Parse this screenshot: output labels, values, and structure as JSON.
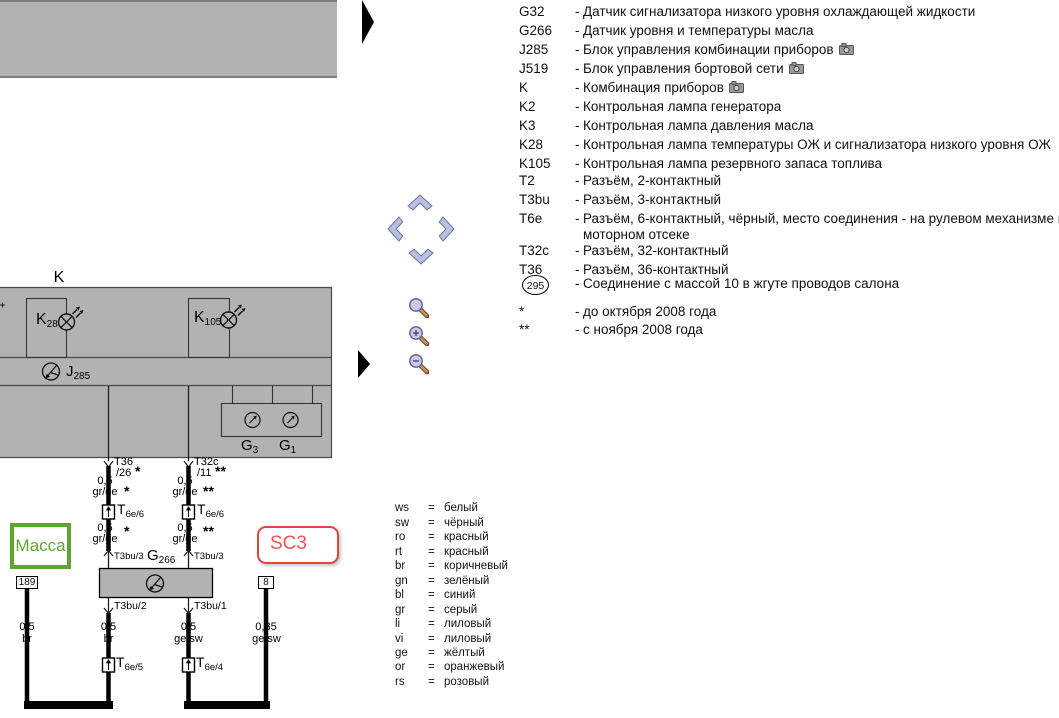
{
  "legend": {
    "dash": "-",
    "rows": [
      {
        "code": "G32",
        "desc": "Датчик сигнализатора низкого уровня охлаждающей жидкости"
      },
      {
        "code": "G266",
        "desc": "Датчик уровня и температуры масла"
      },
      {
        "code": "J285",
        "desc": "Блок управления комбинации приборов",
        "camera": "camera-icon"
      },
      {
        "code": "J519",
        "desc": "Блок управления бортовой сети",
        "camera": "camera-icon"
      },
      {
        "code": "K",
        "desc": "Комбинация приборов",
        "camera": "camera-icon"
      },
      {
        "code": "K2",
        "desc": "Контрольная лампа генератора"
      },
      {
        "code": "K3",
        "desc": "Контрольная лампа давления масла"
      },
      {
        "code": "K28",
        "desc": "Контрольная лампа температуры ОЖ и сигнализатора низкого уровня ОЖ"
      },
      {
        "code": "K105",
        "desc": "Контрольная лампа резервного запаса топлива"
      },
      {
        "code": "T2",
        "desc": "Разъём, 2-контактный"
      },
      {
        "code": "T3bu",
        "desc": "Разъём, 3-контактный"
      },
      {
        "code": "T6e",
        "desc": "Разъём, 6-контактный, чёрный, место соединения - на рулевом механизме в",
        "desc2": "моторном отсеке"
      },
      {
        "code": "T32c",
        "desc": "Разъём, 32-контактный"
      },
      {
        "code": "T36",
        "desc": "Разъём, 36-контактный"
      },
      {
        "code": "295",
        "desc": "Соединение с массой 10 в жгуте проводов салона"
      },
      {
        "code": "*",
        "desc": "до октября 2008 года"
      },
      {
        "code": "**",
        "desc": "с ноября 2008 года"
      }
    ]
  },
  "colors": {
    "eq": "=",
    "rows": [
      {
        "code": "ws",
        "name": "белый"
      },
      {
        "code": "sw",
        "name": "чёрный"
      },
      {
        "code": "ro",
        "name": "красный"
      },
      {
        "code": "rt",
        "name": "красный"
      },
      {
        "code": "br",
        "name": "коричневый"
      },
      {
        "code": "gn",
        "name": "зелёный"
      },
      {
        "code": "bl",
        "name": "синий"
      },
      {
        "code": "gr",
        "name": "серый"
      },
      {
        "code": "li",
        "name": "лиловый"
      },
      {
        "code": "vi",
        "name": "лиловый"
      },
      {
        "code": "ge",
        "name": "жёлтый"
      },
      {
        "code": "or",
        "name": "оранжевый"
      },
      {
        "code": "rs",
        "name": "розовый"
      }
    ]
  },
  "nav": {
    "up": "chevron-up",
    "left": "chevron-left",
    "right": "chevron-right",
    "down": "chevron-down",
    "zoom_reset": "magnifier",
    "zoom_in": "magnifier-plus",
    "zoom_out": "magnifier-minus"
  },
  "diagram": {
    "k_title": "K",
    "k28_main": "K",
    "k28_sub": "28",
    "k105_main": "K",
    "k105_sub": "105",
    "j285_main": "J",
    "j285_sub": "285",
    "g3_main": "G",
    "g3_sub": "3",
    "g1_main": "G",
    "g1_sub": "1",
    "g266_main": "G",
    "g266_sub": "266",
    "massa": "Масса",
    "sc3": "SC3",
    "wire_a": {
      "conn": "T36",
      "pin": "/26",
      "star": "*",
      "cs1": "0,5",
      "col1": "gr/ge",
      "t6e_main": "T",
      "t6e_sub": "6e/6",
      "cs2": "0,5",
      "col2": "gr/ge",
      "t3bu_in": "T3bu/3",
      "t3bu_out": "T3bu/2",
      "cs3": "0,5",
      "col3": "br",
      "t6e_low_main": "T",
      "t6e_low_sub": "6e/5"
    },
    "wire_b": {
      "conn": "T32c",
      "pin": "/11",
      "star": "**",
      "cs1": "0,5",
      "col1": "gr/ge",
      "t6e_main": "T",
      "t6e_sub": "6e/6",
      "cs2": "0,5",
      "col2": "gr/ge",
      "t3bu_in": "T3bu/3",
      "t3bu_out": "T3bu/1",
      "cs3": "0,5",
      "col3": "ge/sw",
      "t6e_low_main": "T",
      "t6e_low_sub": "6e/4"
    },
    "ground_wire": {
      "id": "189",
      "cs": "0,5",
      "col": "br"
    },
    "supply_wire": {
      "id": "8",
      "cs": "0,35",
      "col": "ge/sw"
    },
    "accents": {
      "massa_green": "#61a52f",
      "sc3_red": "#e04540",
      "panel_gray": "#b2b2b2"
    }
  }
}
